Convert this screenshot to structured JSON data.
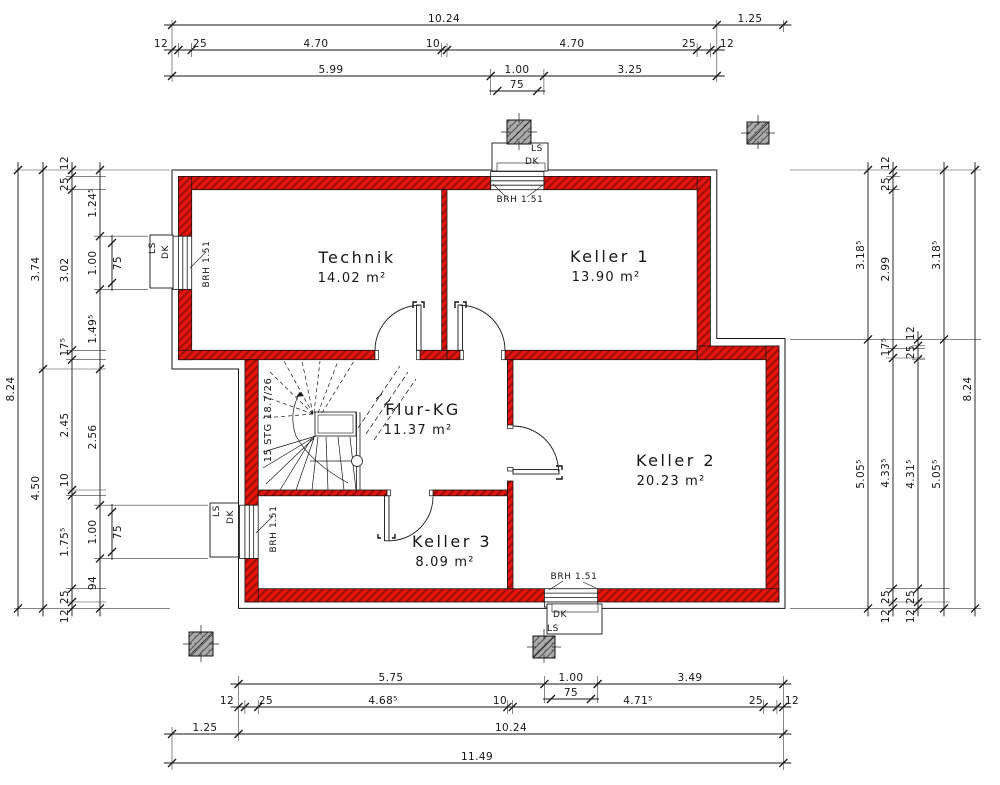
{
  "drawing_type": "basement floor plan (Kellergeschoss)",
  "rooms": [
    {
      "name": "Technik",
      "area": "14.02 m²",
      "nx": 357,
      "ny": 263,
      "ax": 352,
      "ay": 282
    },
    {
      "name": "Keller 1",
      "area": "13.90 m²",
      "nx": 610,
      "ny": 262,
      "ax": 606,
      "ay": 281
    },
    {
      "name": "Flur-KG",
      "area": "11.37 m²",
      "nx": 423,
      "ny": 415,
      "ax": 418,
      "ay": 434
    },
    {
      "name": "Keller 2",
      "area": "20.23 m²",
      "nx": 676,
      "ny": 466,
      "ax": 671,
      "ay": 485
    },
    {
      "name": "Keller 3",
      "area": "8.09 m²",
      "nx": 452,
      "ny": 547,
      "ax": 445,
      "ay": 566
    }
  ],
  "annotations": [
    {
      "t": "BRH 1.51",
      "x": 520,
      "y": 202,
      "r": 0,
      "c": "small",
      "n": "window-sill-note-top"
    },
    {
      "t": "BRH 1.51",
      "x": 209,
      "y": 264,
      "r": -90,
      "c": "small",
      "n": "window-sill-note-left"
    },
    {
      "t": "BRH 1.51",
      "x": 276,
      "y": 529,
      "r": -90,
      "c": "small",
      "n": "window-sill-note-keller3"
    },
    {
      "t": "BRH 1.51",
      "x": 574,
      "y": 579,
      "r": 0,
      "c": "small",
      "n": "window-sill-note-bottom"
    },
    {
      "t": "LS",
      "x": 537,
      "y": 151,
      "r": 0,
      "c": "small",
      "n": "lightwell-ls-top"
    },
    {
      "t": "DK",
      "x": 532,
      "y": 164,
      "r": 0,
      "c": "small",
      "n": "lightwell-dk-top"
    },
    {
      "t": "DK",
      "x": 560,
      "y": 617,
      "r": 0,
      "c": "small",
      "n": "lightwell-dk-bottom"
    },
    {
      "t": "LS",
      "x": 553,
      "y": 631,
      "r": 0,
      "c": "small",
      "n": "lightwell-ls-bottom"
    },
    {
      "t": "LS",
      "x": 155,
      "y": 248,
      "r": -90,
      "c": "small",
      "n": "lightwell-ls-left-top"
    },
    {
      "t": "DK",
      "x": 168,
      "y": 252,
      "r": -90,
      "c": "small",
      "n": "lightwell-dk-left-top"
    },
    {
      "t": "LS",
      "x": 219,
      "y": 511,
      "r": -90,
      "c": "small",
      "n": "lightwell-ls-left-bottom"
    },
    {
      "t": "DK",
      "x": 233,
      "y": 517,
      "r": -90,
      "c": "small",
      "n": "lightwell-dk-left-bottom"
    },
    {
      "t": "15 STG 18.7/26",
      "x": 271,
      "y": 420,
      "r": -90,
      "c": "stairlab",
      "n": "stair-label"
    }
  ],
  "dim_chains": [
    {
      "o": "h",
      "p": 25,
      "t": [
        172,
        716.8,
        783.3
      ],
      "lab": [
        {
          "t": "10.24",
          "a": 444
        },
        {
          "t": "1.25",
          "a": 750
        }
      ]
    },
    {
      "o": "h",
      "p": 50,
      "t": [
        172,
        178.4,
        191.7,
        441.7,
        447,
        697.1,
        710.4,
        716.8
      ],
      "lab": [
        {
          "t": "12",
          "a": 161
        },
        {
          "t": "25",
          "a": 200
        },
        {
          "t": "4.70",
          "a": 316
        },
        {
          "t": "10",
          "a": 433
        },
        {
          "t": "4.70",
          "a": 572
        },
        {
          "t": "25",
          "a": 689
        },
        {
          "t": "12",
          "a": 727
        }
      ]
    },
    {
      "o": "h",
      "p": 76,
      "t": [
        172,
        490.7,
        543.9,
        716.8
      ],
      "lab": [
        {
          "t": "5.99",
          "a": 331
        },
        {
          "t": "1.00",
          "a": 517
        },
        {
          "t": "3.25",
          "a": 630
        }
      ]
    },
    {
      "o": "h",
      "p": 91,
      "t": [
        497.3,
        537.2
      ],
      "lab": [
        {
          "t": "75",
          "a": 517
        }
      ]
    },
    {
      "o": "h",
      "p": 684,
      "t": [
        238.5,
        544.4,
        597.6,
        783.3
      ],
      "lab": [
        {
          "t": "5.75",
          "a": 391
        },
        {
          "t": "1.00",
          "a": 571
        },
        {
          "t": "3.49",
          "a": 690
        }
      ]
    },
    {
      "o": "h",
      "p": 699,
      "t": [
        551,
        591
      ],
      "lab": [
        {
          "t": "75",
          "a": 571
        }
      ]
    },
    {
      "o": "h",
      "p": 707,
      "t": [
        238.5,
        244.9,
        258.2,
        507.4,
        512.7,
        763.6,
        776.9,
        783.3
      ],
      "lab": [
        {
          "t": "12",
          "a": 227
        },
        {
          "t": "25",
          "a": 266
        },
        {
          "t": "4.68⁵",
          "a": 383
        },
        {
          "t": "10",
          "a": 500
        },
        {
          "t": "4.71⁵",
          "a": 638
        },
        {
          "t": "25",
          "a": 756
        },
        {
          "t": "12",
          "a": 792
        }
      ]
    },
    {
      "o": "h",
      "p": 734,
      "t": [
        172,
        238.5,
        783.3
      ],
      "lab": [
        {
          "t": "1.25",
          "a": 205
        },
        {
          "t": "10.24",
          "a": 511
        }
      ]
    },
    {
      "o": "h",
      "p": 763,
      "t": [
        172,
        783.3
      ],
      "lab": [
        {
          "t": "11.49",
          "a": 477
        }
      ]
    },
    {
      "o": "v",
      "p": 18,
      "t": [
        170,
        608.4
      ],
      "lab": [
        {
          "t": "8.24",
          "a": 389
        }
      ]
    },
    {
      "o": "v",
      "p": 43,
      "t": [
        170,
        369,
        608.4
      ],
      "lab": [
        {
          "t": "3.74",
          "a": 269
        },
        {
          "t": "4.50",
          "a": 488
        }
      ]
    },
    {
      "o": "v",
      "p": 72,
      "t": [
        170,
        176.4,
        189.7,
        350.3,
        359.7,
        490,
        495.3,
        588.7,
        602,
        608.4
      ],
      "lab": [
        {
          "t": "12",
          "a": 163
        },
        {
          "t": "25",
          "a": 184
        },
        {
          "t": "3.02",
          "a": 270
        },
        {
          "t": "17⁵",
          "a": 347
        },
        {
          "t": "2.45",
          "a": 425
        },
        {
          "t": "10",
          "a": 480
        },
        {
          "t": "1.75⁵",
          "a": 542
        },
        {
          "t": "25",
          "a": 597
        },
        {
          "t": "12",
          "a": 616
        }
      ]
    },
    {
      "o": "v",
      "p": 100,
      "t": [
        170,
        236.2,
        289.4,
        369,
        505.2,
        558.4,
        608.4
      ],
      "lab": [
        {
          "t": "1.24⁵",
          "a": 203
        },
        {
          "t": "1.00",
          "a": 263
        },
        {
          "t": "1.49⁵",
          "a": 329
        },
        {
          "t": "2.56",
          "a": 437
        },
        {
          "t": "1.00",
          "a": 532
        },
        {
          "t": "94",
          "a": 583
        }
      ]
    },
    {
      "o": "v",
      "p": 112,
      "t": [
        243,
        283
      ],
      "side": 1,
      "lab": [
        {
          "t": "75",
          "a": 263
        }
      ]
    },
    {
      "o": "v",
      "p": 112,
      "t": [
        512,
        552
      ],
      "side": 1,
      "lab": [
        {
          "t": "75",
          "a": 532
        }
      ]
    },
    {
      "o": "v",
      "p": 868,
      "t": [
        170,
        339.4,
        608.4
      ],
      "lab": [
        {
          "t": "3.18⁵",
          "a": 255
        },
        {
          "t": "5.05⁵",
          "a": 474
        }
      ]
    },
    {
      "o": "v",
      "p": 893,
      "t": [
        170,
        176.4,
        189.7,
        348.7,
        358,
        588.7,
        602,
        608.4
      ],
      "lab": [
        {
          "t": "12",
          "a": 163
        },
        {
          "t": "25",
          "a": 184
        },
        {
          "t": "2.99",
          "a": 269
        },
        {
          "t": "17⁵",
          "a": 347
        },
        {
          "t": "4.33⁵",
          "a": 473
        },
        {
          "t": "25",
          "a": 597
        },
        {
          "t": "12",
          "a": 616
        }
      ]
    },
    {
      "o": "v",
      "p": 918,
      "t": [
        339.4,
        345.8,
        359.2,
        588.7,
        602,
        608.4
      ],
      "lab": [
        {
          "t": "12",
          "a": 333
        },
        {
          "t": "25",
          "a": 352
        },
        {
          "t": "4.31⁵",
          "a": 474
        },
        {
          "t": "25",
          "a": 597
        },
        {
          "t": "12",
          "a": 616
        }
      ]
    },
    {
      "o": "v",
      "p": 944,
      "t": [
        170,
        339.4,
        608.4
      ],
      "lab": [
        {
          "t": "3.18⁵",
          "a": 255
        },
        {
          "t": "5.05⁵",
          "a": 474
        }
      ]
    },
    {
      "o": "v",
      "p": 975,
      "t": [
        170,
        608.4
      ],
      "lab": [
        {
          "t": "8.24",
          "a": 389
        }
      ]
    }
  ],
  "colors": {
    "wall_red": "#e8150e",
    "wall_hatch": "#9c0f07",
    "chimney_gray": "#ababab",
    "line": "#161616"
  }
}
